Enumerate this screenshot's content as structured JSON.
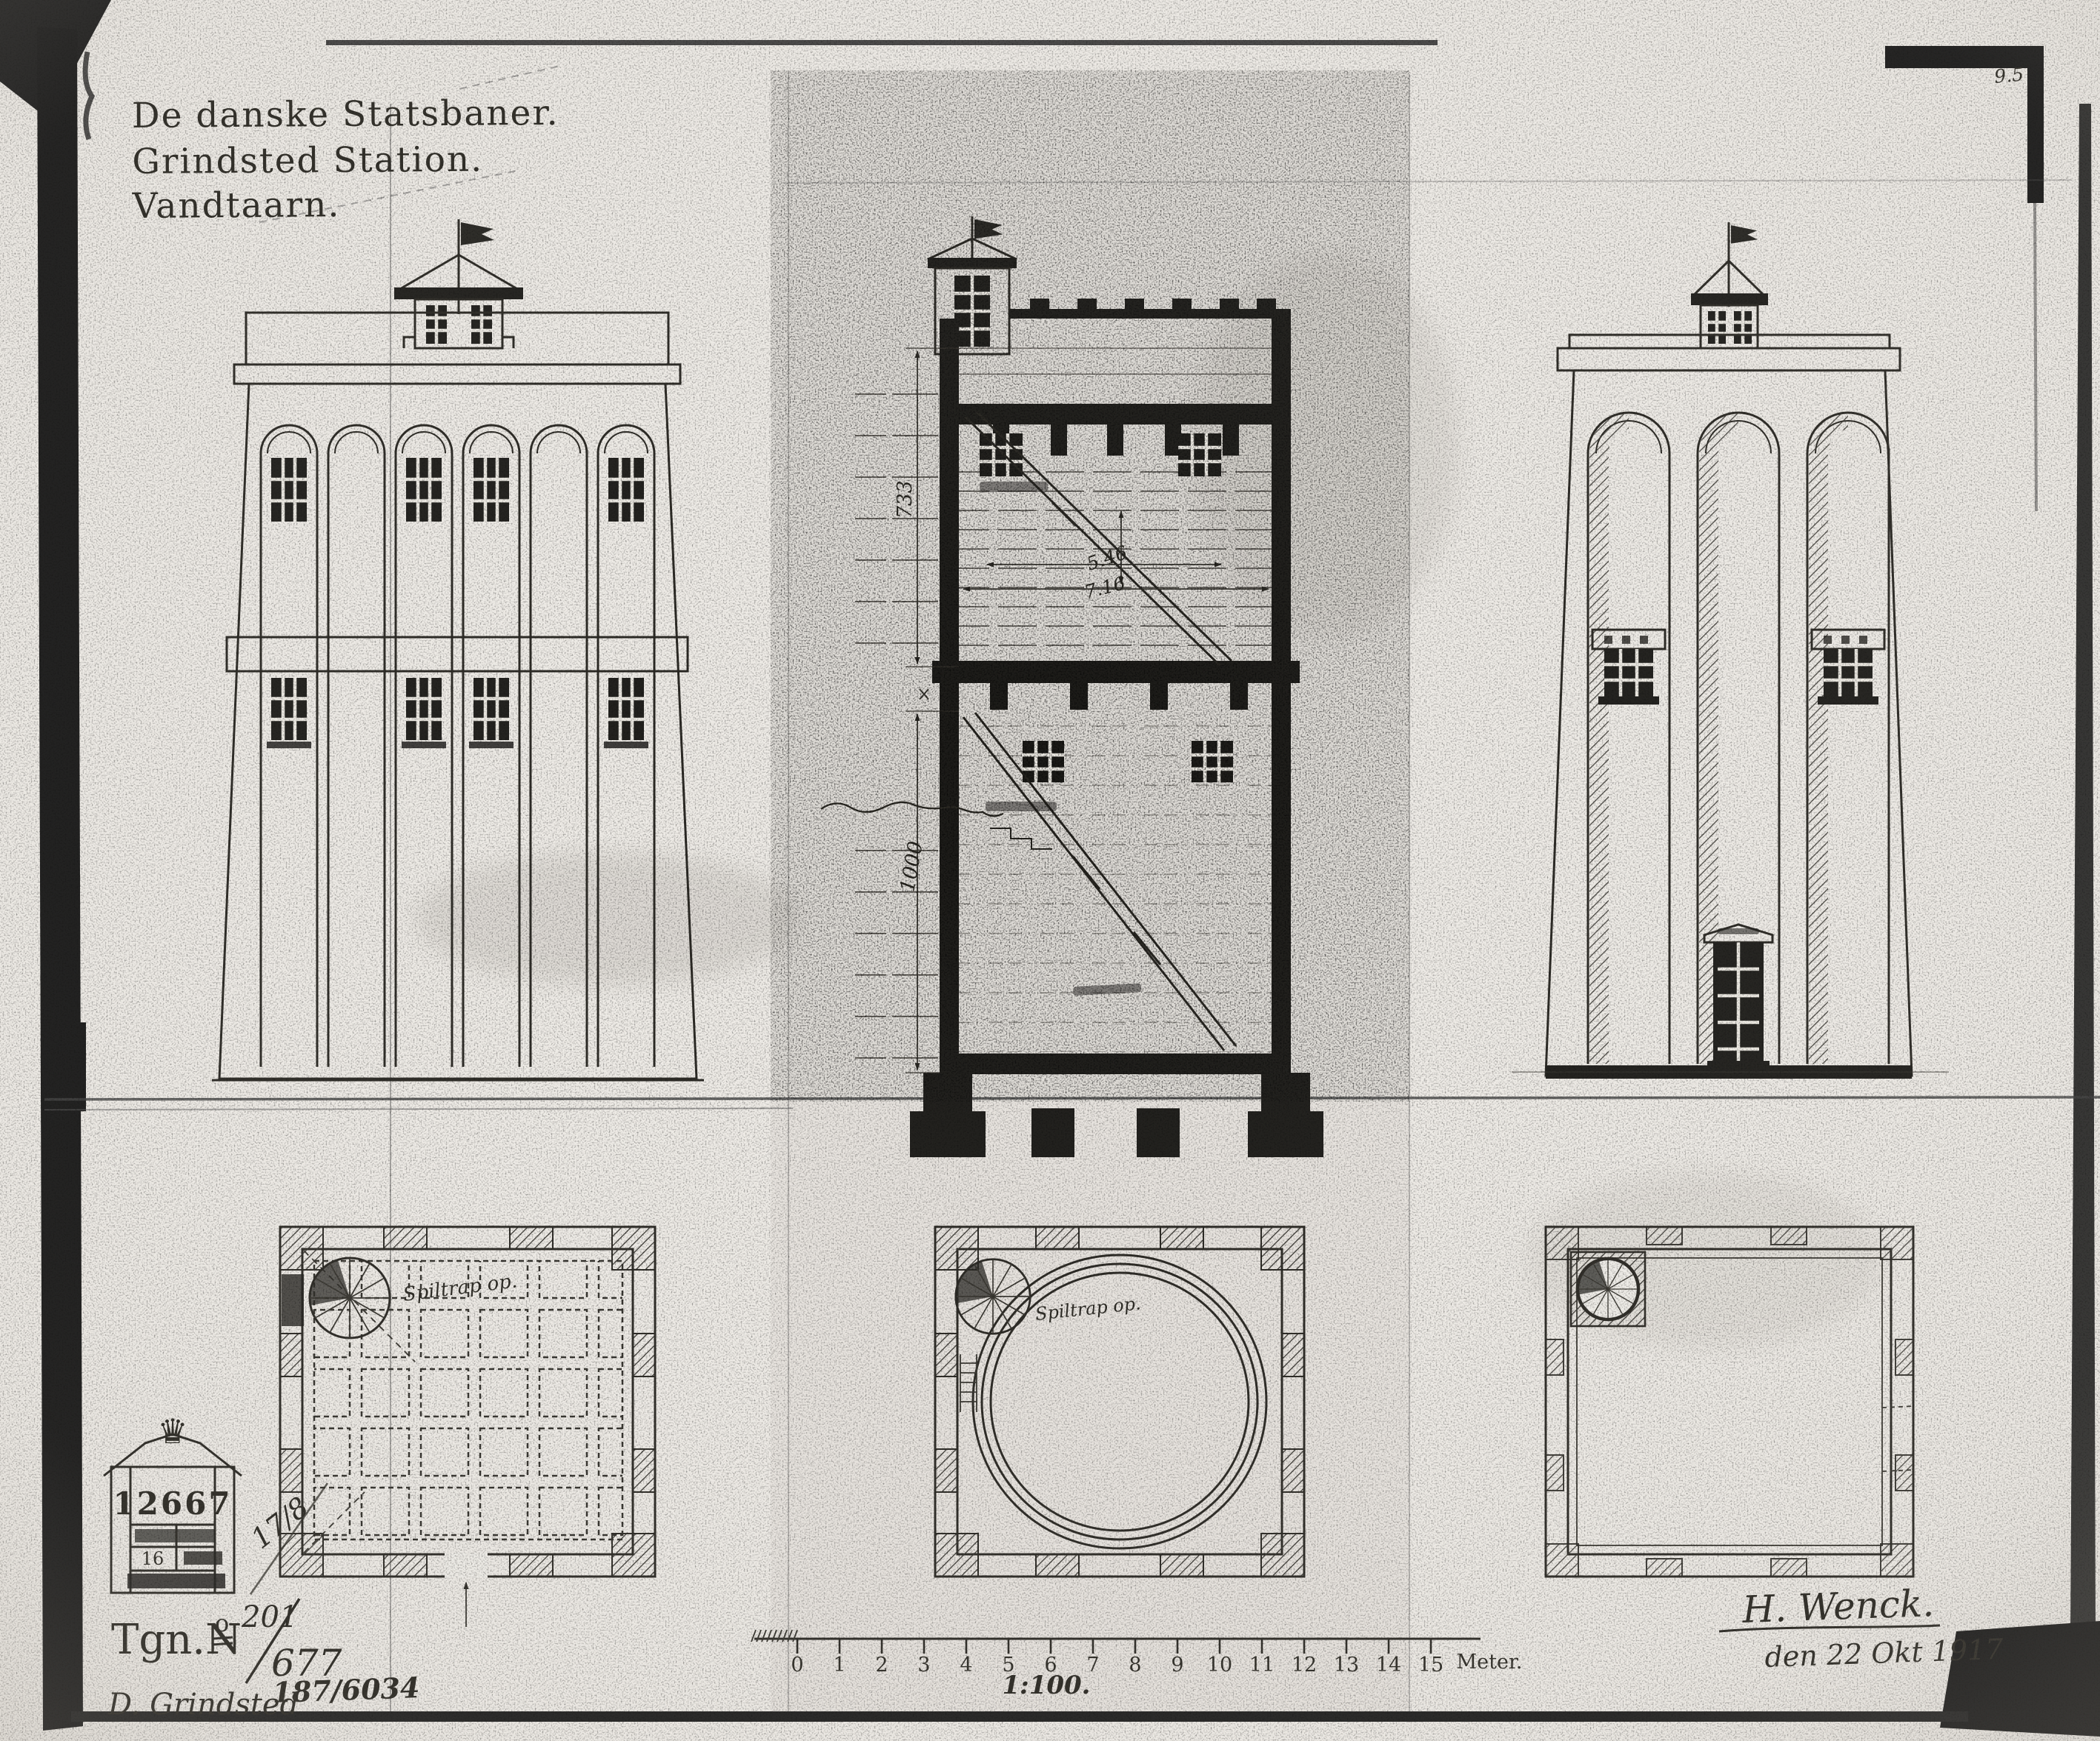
{
  "palette": {
    "ink": "#1d1c19",
    "paper": "#efece7",
    "scan_black": "#131313"
  },
  "sheet": {
    "corner_mark": "9.5"
  },
  "title": {
    "line1": "De danske Statsbaner.",
    "line2": "Grindsted Station.",
    "line3": "Vandtaarn."
  },
  "section": {
    "dim_upper": "733",
    "dim_lower": "1000",
    "dim_tank_a": "5.46",
    "dim_tank_b": "7.16"
  },
  "plans": {
    "left_note": "Spiltrap op.",
    "middle_note": "Spiltrap op."
  },
  "scalebar": {
    "ticks": [
      "0",
      "1",
      "2",
      "3",
      "4",
      "5",
      "6",
      "7",
      "8",
      "9",
      "10",
      "11",
      "12",
      "13",
      "14",
      "15"
    ],
    "unit": "Meter.",
    "ratio": "1:100."
  },
  "stamp": {
    "crown_icon": "♛",
    "number": "12667",
    "row": "16",
    "side_note": "17/8"
  },
  "footer": {
    "tgn_label": "Tgn.N",
    "tgn_sup": "o",
    "tgn_num": "201",
    "tgn_den": "677",
    "archive": "187/6034",
    "location": "D. Grindsted"
  },
  "signature": {
    "name": "H. Wenck.",
    "date": "den 22 Okt 1917"
  }
}
